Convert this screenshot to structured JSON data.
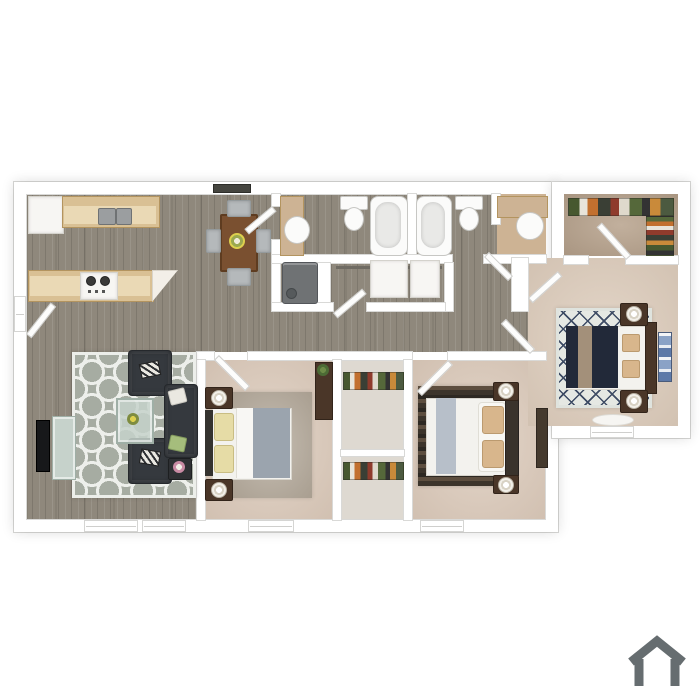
{
  "canvas": {
    "width": 700,
    "height": 700,
    "background": "#ffffff"
  },
  "scene": {
    "type": "3d-top-down-floor-plan",
    "rooms": [
      {
        "id": "kitchen",
        "floor": "wood",
        "furniture": [
          "refrigerator",
          "sink-counter",
          "upper-cabinets",
          "l-shaped-counter",
          "stove-cooktop"
        ]
      },
      {
        "id": "dining-area",
        "floor": "wood",
        "furniture": [
          "dining-table",
          "chair-north",
          "chair-south",
          "chair-west",
          "chair-east",
          "flower-centerpiece"
        ]
      },
      {
        "id": "living-room",
        "floor": "wood",
        "furniture": [
          "trellis-rug",
          "armchair-north",
          "armchair-south",
          "sofa",
          "glass-coffee-table",
          "side-table",
          "tv-console",
          "tv"
        ]
      },
      {
        "id": "bathroom-1",
        "floor": "wood",
        "furniture": [
          "vanity",
          "oval-sink",
          "toilet",
          "bathtub"
        ]
      },
      {
        "id": "master-bathroom",
        "floor": "wood-and-tan",
        "furniture": [
          "bathtub",
          "toilet",
          "vanity-counter",
          "round-sink"
        ]
      },
      {
        "id": "utility-closet",
        "floor": "wood",
        "furniture": [
          "water-heater"
        ]
      },
      {
        "id": "linen-closet",
        "floor": "wood",
        "furniture": [
          "hanging-rod",
          "white-cabinet-1",
          "white-cabinet-2"
        ]
      },
      {
        "id": "hallway",
        "floor": "wood",
        "furniture": []
      },
      {
        "id": "walk-in-closet",
        "floor": "carpet",
        "furniture": [
          "clothes-rack-north",
          "clothes-rack-east"
        ]
      },
      {
        "id": "master-bedroom",
        "floor": "carpet",
        "furniture": [
          "lattice-rug",
          "bed-navy-blanket",
          "headboard",
          "nightstand-north",
          "nightstand-south",
          "lamps",
          "wall-art",
          "bench-rug"
        ]
      },
      {
        "id": "bedroom-2",
        "floor": "carpet",
        "furniture": [
          "area-rug",
          "bed-gray-blanket",
          "yellow-pillows",
          "nightstand-north",
          "nightstand-south",
          "lamps",
          "dresser-with-plant"
        ]
      },
      {
        "id": "bedroom-3",
        "floor": "carpet",
        "furniture": [
          "striped-rug",
          "bed-white-duvet",
          "tan-pillows",
          "nightstand-north",
          "nightstand-south",
          "lamps",
          "dresser"
        ]
      },
      {
        "id": "closet-column",
        "floor": "light",
        "furniture": [
          "clothes-rack-upper",
          "clothes-rack-lower",
          "shelf"
        ]
      }
    ],
    "openings": [
      "entry-door-west",
      "bathroom-1-door",
      "master-bathroom-door",
      "linen-closet-door",
      "walk-in-closet-door",
      "master-bedroom-door",
      "master-suite-door",
      "bedroom-2-door",
      "bedroom-3-door"
    ],
    "windows": [
      "living-window-1",
      "living-window-2",
      "bedroom-2-window",
      "bedroom-3-window",
      "master-window",
      "vent-north"
    ]
  },
  "palette": {
    "bg": "#ffffff",
    "wallFill": "#ffffff",
    "wallEdge": "#d9d9d7",
    "planShadow": "rgba(0,0,0,0.14)",
    "woodBase": "#8f887c",
    "carpetBedroom": "#dccaba",
    "carpetMaster": "#ddccbb",
    "carpetCloset": "#b7a28c",
    "closetFloor": "#ded9d1",
    "tanVanity": "#cdb394",
    "counterTan": "#d9c094",
    "counterLight": "#ead9b5",
    "counterEdge": "#b3945f",
    "applianceWhite": "#f7f6f3",
    "fixtureWhite": "#fbfbfa",
    "fixtureEdge": "#c7c7c4",
    "steelGray": "#9b9ea0",
    "heaterGray": "#6f7274",
    "tableBrown": "#7a5030",
    "chairGray": "#b5b9bb",
    "chairEdge": "#949a9c",
    "sofaCharcoal": "#35393e",
    "cushionWhite": "#eae8e1",
    "cushionGreen": "#a5bd7c",
    "rugLivingBase": "#a6aca2",
    "rugLivingPattern": "#edefeb",
    "rugMasterBase": "#e5e8e3",
    "rugMasterLattice": "#3d4b64",
    "rugBed2": "#b3a899",
    "rugBed3A": "#3c342b",
    "rugBed3B": "#5d4e3f",
    "beddingWhite": "#f3f2ee",
    "blanketNavy": "#222939",
    "blanketGray": "#9ba4ae",
    "runnerTan": "#a3907a",
    "runnerGray": "#b7bfc9",
    "pillowYellow": "#e6dca6",
    "pillowTan": "#d8b68c",
    "nightstandBrown": "#4a3628",
    "lampTrim": "#b9b2a4",
    "tvBlack": "#17181a",
    "glassGreen": "#c6d2cb",
    "plantGreen": "#4c6b35",
    "flowerYellow": "#ddd04e",
    "flowerPink": "#c98ba4",
    "artBlue": "#5d79a8",
    "ventDark": "#45453f",
    "logoGray": "#666d70"
  },
  "logo": {
    "icon": "house-outline",
    "color": "#666d70",
    "position": "bottom-right"
  }
}
